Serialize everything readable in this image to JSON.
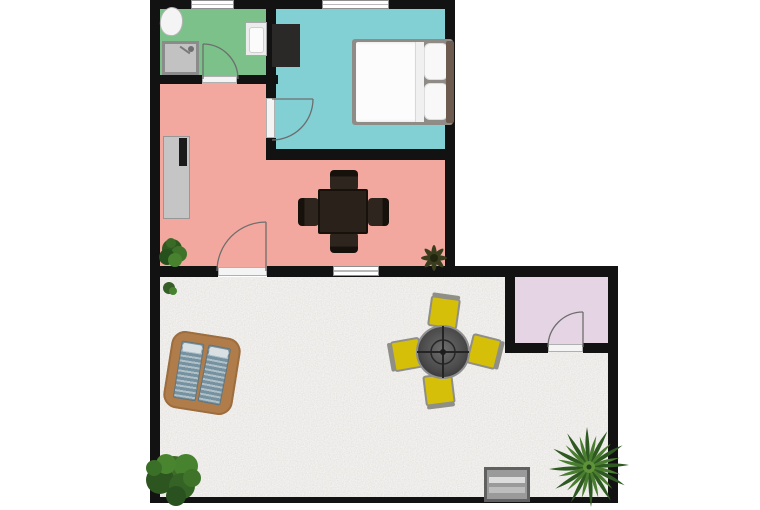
{
  "title": "apartment-floor-plan",
  "colors": {
    "wall": "#121212",
    "bathroom": "#7bc189",
    "bedroom": "#82cfd4",
    "living_room": "#f3a89f",
    "storage_room": "#e5d4e3",
    "patio_gravel": "#e6e4df",
    "deck_wood": "#b07c49",
    "lounger_blue": "#7692a1",
    "patio_chair_yellow": "#d6bf08",
    "dining_set_dark": "#29211a",
    "plant_green": "#47822e"
  },
  "rooms": [
    {
      "name": "bathroom",
      "color": "#7bc189",
      "fixtures": [
        "toilet",
        "shower",
        "sink"
      ]
    },
    {
      "name": "bedroom",
      "color": "#82cfd4",
      "fixtures": [
        "double-bed",
        "wardrobe"
      ]
    },
    {
      "name": "living-room",
      "color": "#f3a89f",
      "fixtures": [
        "sideboard-with-tv",
        "dining-table",
        "dining-chairs x4",
        "plant x2"
      ]
    },
    {
      "name": "storage-room",
      "color": "#e5d4e3",
      "fixtures": []
    },
    {
      "name": "patio",
      "color": "#e6e4df",
      "fixtures": [
        "double-sun-lounger-on-deck",
        "round-mesh-table",
        "yellow-chair x4",
        "grill-box",
        "palm-plant",
        "bush-plant",
        "grass-tuft"
      ]
    }
  ],
  "openings": {
    "doors": 4,
    "windows": 3
  }
}
